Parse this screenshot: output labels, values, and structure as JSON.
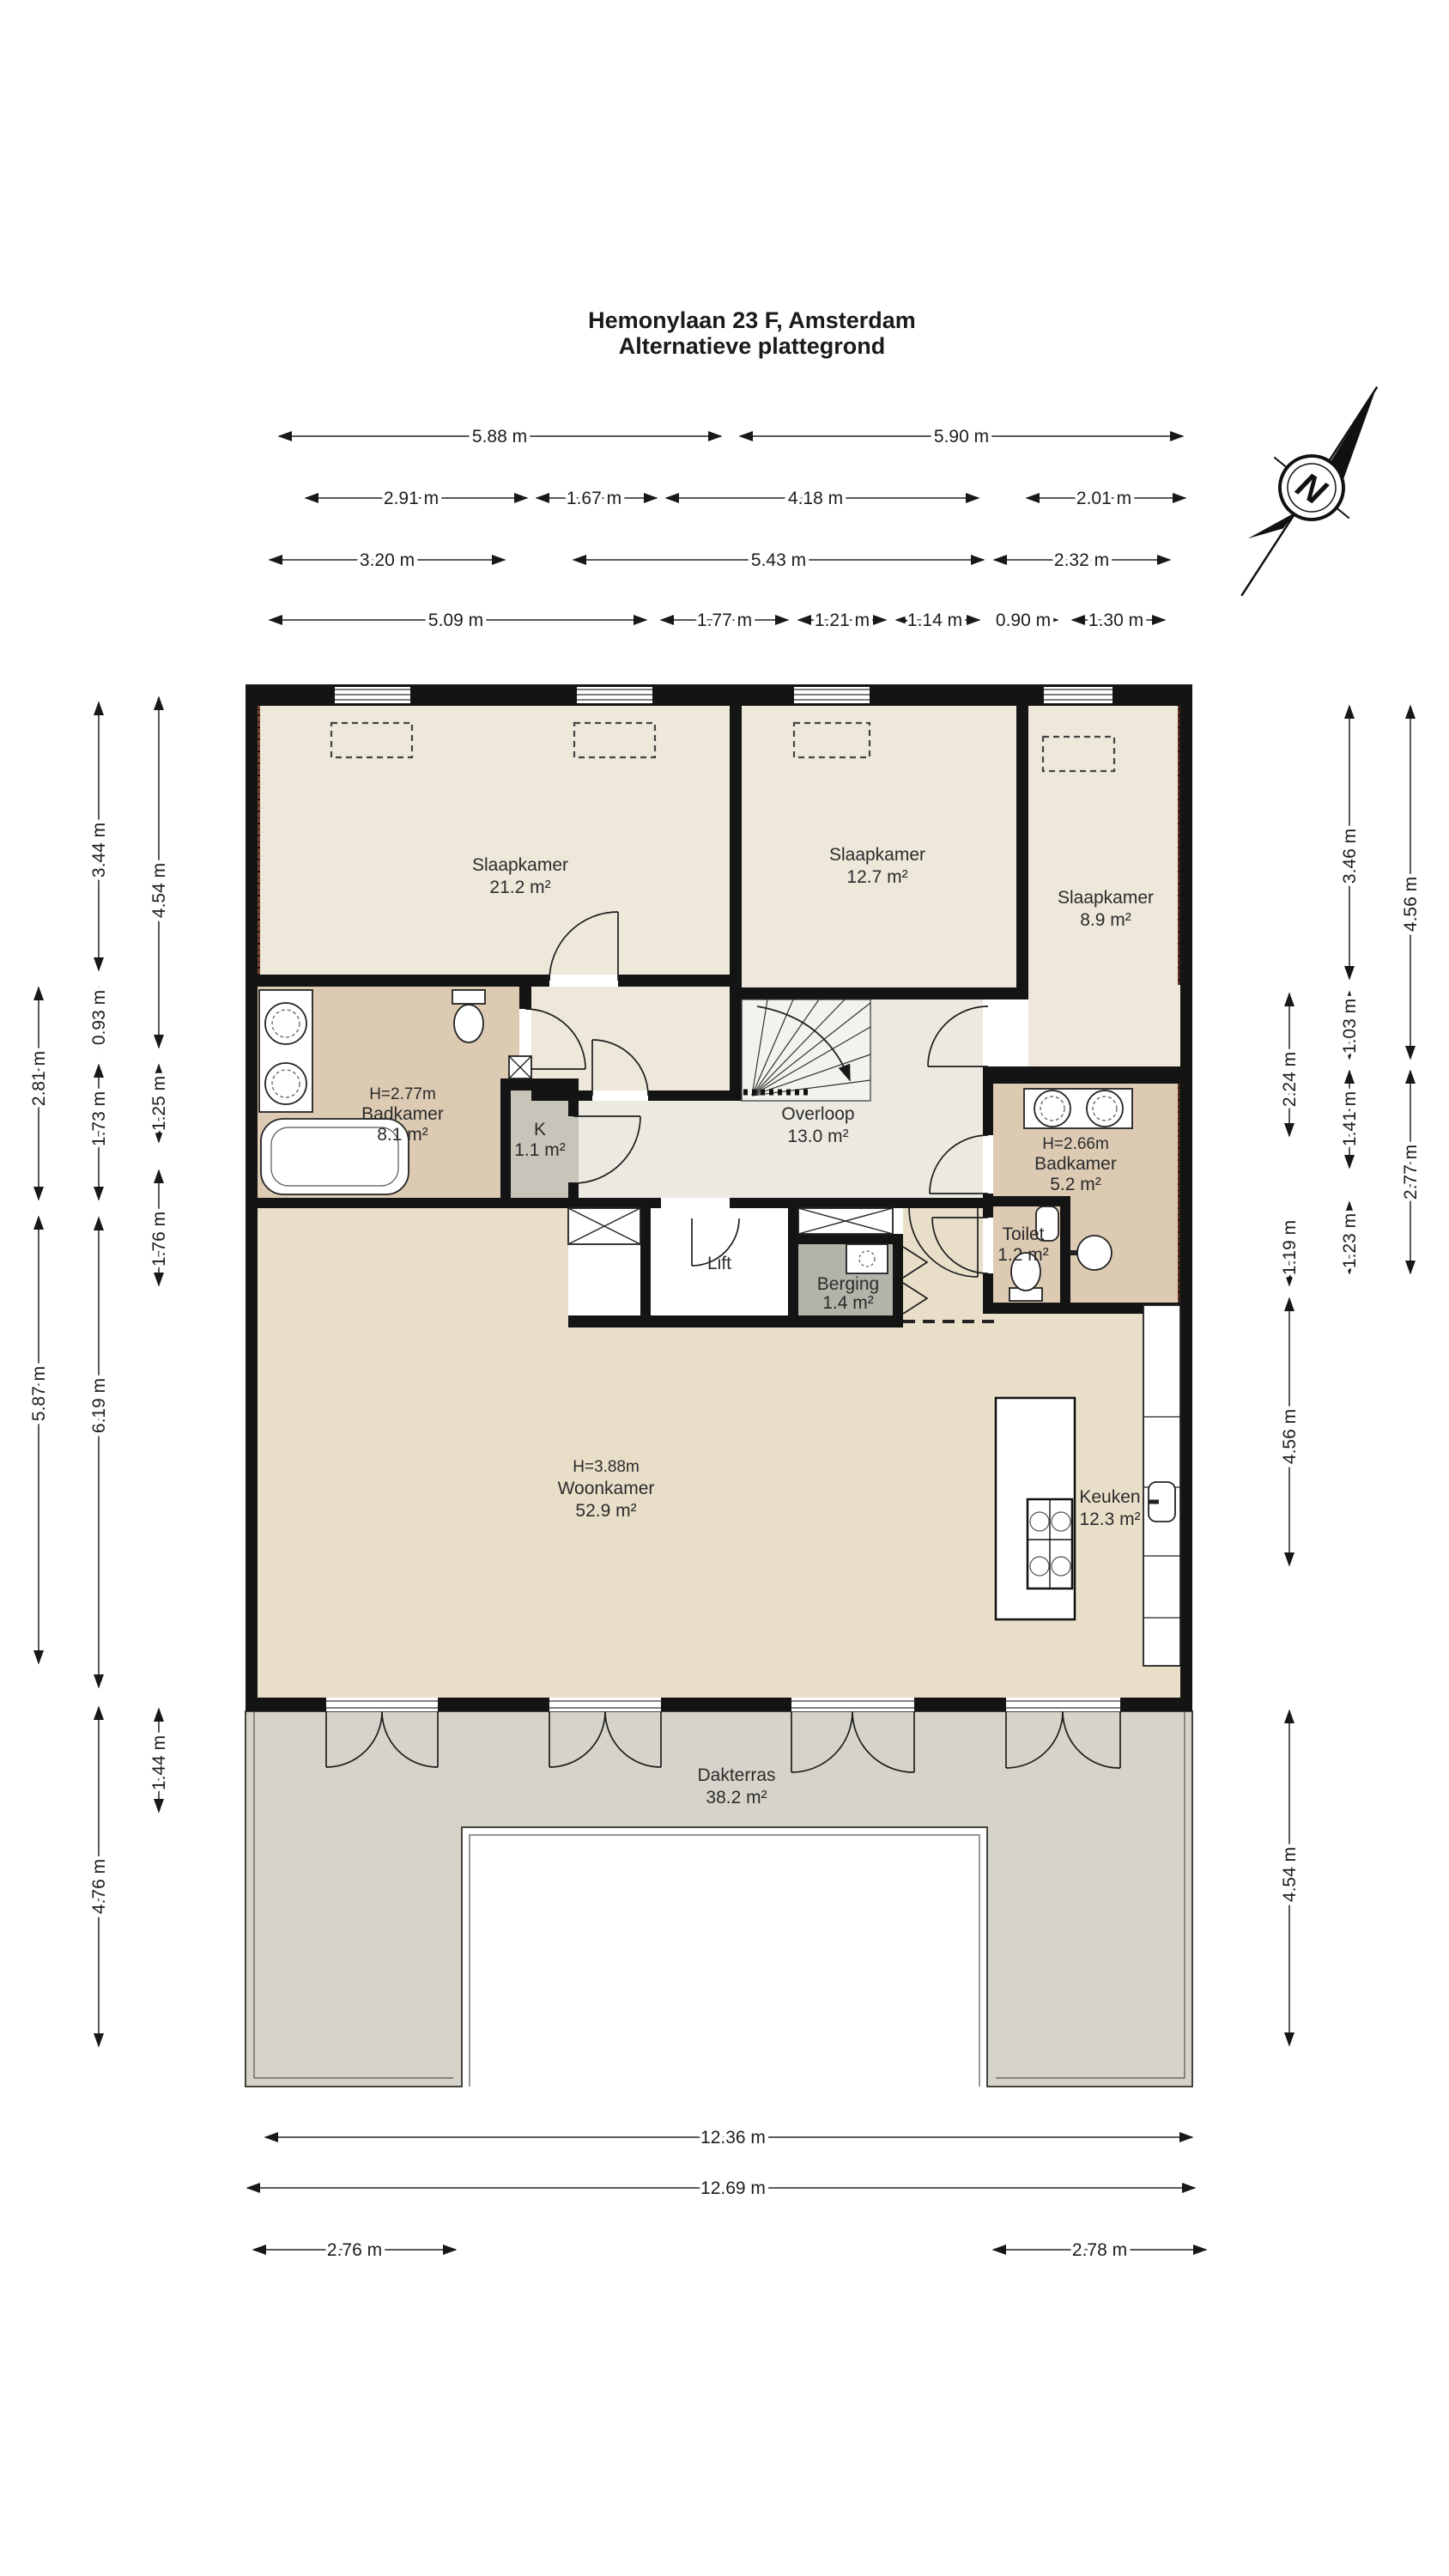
{
  "title": {
    "line1": "Hemonylaan 23 F, Amsterdam",
    "line2": "Alternatieve plattegrond"
  },
  "compass": {
    "label": "N"
  },
  "rooms": [
    {
      "name": "Slaapkamer",
      "area": "21.2 m²"
    },
    {
      "name": "Slaapkamer",
      "area": "12.7 m²"
    },
    {
      "name": "Slaapkamer",
      "area": "8.9 m²"
    },
    {
      "name": "Badkamer",
      "area": "8.1 m²",
      "ceiling": "H=2.77m"
    },
    {
      "name": "K",
      "area": "1.1 m²"
    },
    {
      "name": "Overloop",
      "area": "13.0 m²"
    },
    {
      "name": "Badkamer",
      "area": "5.2 m²",
      "ceiling": "H=2.66m"
    },
    {
      "name": "Toilet",
      "area": "1.2 m²"
    },
    {
      "name": "Lift"
    },
    {
      "name": "Berging",
      "area": "1.4 m²"
    },
    {
      "name": "Woonkamer",
      "area": "52.9 m²",
      "ceiling": "H=3.88m"
    },
    {
      "name": "Keuken",
      "area": "12.3 m²"
    },
    {
      "name": "Dakterras",
      "area": "38.2 m²"
    }
  ],
  "dimensions": {
    "top": [
      [
        "5.88 m",
        "5.90 m"
      ],
      [
        "2.91 m",
        "1.67 m",
        "4.18 m",
        "2.01 m"
      ],
      [
        "3.20 m",
        "5.43 m",
        "2.32 m"
      ],
      [
        "5.09 m",
        "1.77 m",
        "1.21 m",
        "1.14 m",
        "0.90 m",
        "1.30 m"
      ]
    ],
    "left": [
      [
        "2.81 m",
        "5.87 m"
      ],
      [
        "3.44 m",
        "0.93 m",
        "1.73 m",
        "6.19 m",
        "4.76 m"
      ],
      [
        "4.54 m",
        "1.25 m",
        "1.76 m",
        "1.44 m"
      ]
    ],
    "right": [
      [
        "2.24 m",
        "1.19 m",
        "4.56 m",
        "4.54 m"
      ],
      [
        "3.46 m",
        "1.03 m",
        "1.41 m",
        "1.23 m"
      ],
      [
        "4.56 m",
        "2.77 m"
      ]
    ],
    "bottom": [
      "12.36 m",
      "12.69 m",
      "2.76 m",
      "2.78 m"
    ]
  },
  "colors": {
    "wall": "#141414",
    "bedroom": "#eee8da",
    "hall": "#ebe9e0",
    "bathroom": "#dccab3",
    "closet": "#c7c4ba",
    "storage": "#b4b3a9",
    "living": "#e9dfc9",
    "terrace": "#d6d4ca",
    "roof_tiles": "#7d4334"
  }
}
